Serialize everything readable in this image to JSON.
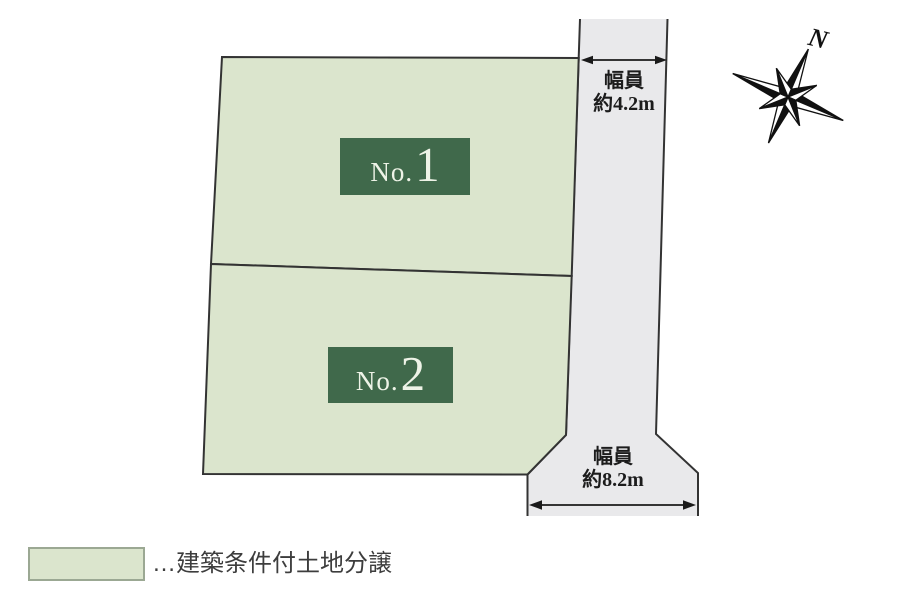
{
  "diagram_title": "分譲地区画図",
  "lots": [
    {
      "label_prefix": "No.",
      "label_number": "1"
    },
    {
      "label_prefix": "No.",
      "label_number": "2"
    }
  ],
  "road": {
    "top_width_line1": "幅員",
    "top_width_line2": "約4.2m",
    "bottom_width_line1": "幅員",
    "bottom_width_line2": "約8.2m"
  },
  "compass": {
    "north_label": "N"
  },
  "legend": {
    "text": "…建築条件付土地分譲"
  },
  "colors": {
    "lot_fill": "#dbe5cd",
    "road_fill": "#e9e9eb",
    "outline": "#333333",
    "lot_label_bg": "#40694b",
    "lot_label_text": "#eef3e7",
    "annotation_text": "#1c1c1c",
    "legend_swatch_border": "#9ba893",
    "compass_color": "#111111",
    "background": "#ffffff"
  }
}
